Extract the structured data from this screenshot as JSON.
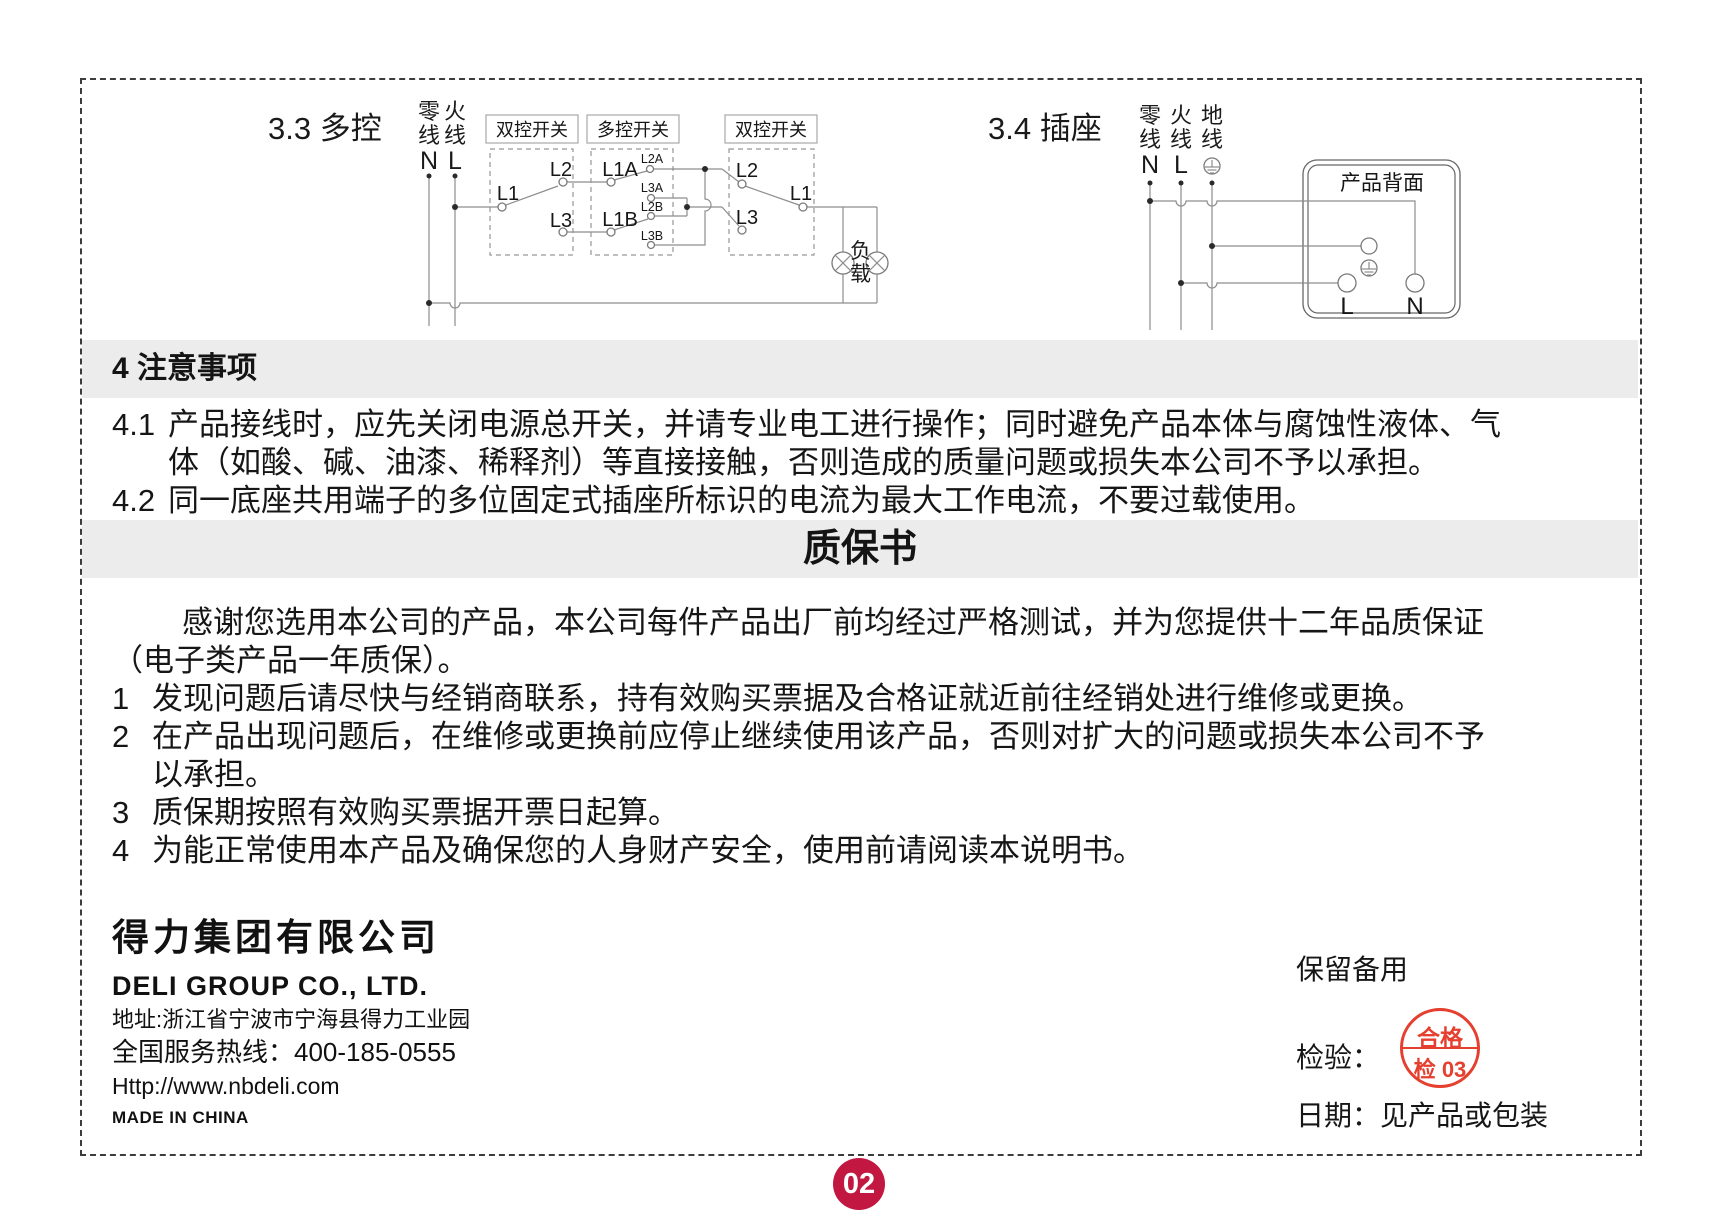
{
  "page": {
    "number": "02"
  },
  "diagram_multi": {
    "title": "3.3 多控",
    "neutral_label": "零线",
    "neutral_letter": "N",
    "live_label": "火线",
    "live_letter": "L",
    "switch1_title": "双控开关",
    "switch2_title": "多控开关",
    "switch3_title": "双控开关",
    "sw1_l1": "L1",
    "sw1_l2": "L2",
    "sw1_l3": "L3",
    "sw2_l1a": "L1A",
    "sw2_l1b": "L1B",
    "sw2_l2a": "L2A",
    "sw2_l3a": "L3A",
    "sw2_l2b": "L2B",
    "sw2_l3b": "L3B",
    "sw3_l1": "L1",
    "sw3_l2": "L2",
    "sw3_l3": "L3",
    "load_label": "负载"
  },
  "diagram_socket": {
    "title": "3.4 插座",
    "neutral_label": "零线",
    "neutral_letter": "N",
    "live_label": "火线",
    "live_letter": "L",
    "earth_label": "地线",
    "panel_title": "产品背面",
    "terminal_l": "L",
    "terminal_n": "N"
  },
  "precautions": {
    "heading": "4 注意事项",
    "items": [
      {
        "num": "4.1",
        "lines": [
          "产品接线时，应先关闭电源总开关，并请专业电工进行操作；同时避免产品本体与腐蚀性液体、气",
          "体（如酸、碱、油漆、稀释剂）等直接接触，否则造成的质量问题或损失本公司不予以承担。"
        ]
      },
      {
        "num": "4.2",
        "lines": [
          "同一底座共用端子的多位固定式插座所标识的电流为最大工作电流，不要过载使用。"
        ]
      }
    ]
  },
  "warranty": {
    "heading": "质保书",
    "intro_lines": [
      "感谢您选用本公司的产品，本公司每件产品出厂前均经过严格测试，并为您提供十二年品质保证",
      "（电子类产品一年质保）。"
    ],
    "items": [
      {
        "num": "1",
        "lines": [
          "发现问题后请尽快与经销商联系，持有效购买票据及合格证就近前往经销处进行维修或更换。"
        ]
      },
      {
        "num": "2",
        "lines": [
          "在产品出现问题后，在维修或更换前应停止继续使用该产品，否则对扩大的问题或损失本公司不予",
          "以承担。"
        ]
      },
      {
        "num": "3",
        "lines": [
          "质保期按照有效购买票据开票日起算。"
        ]
      },
      {
        "num": "4",
        "lines": [
          "为能正常使用本产品及确保您的人身财产安全，使用前请阅读本说明书。"
        ]
      }
    ]
  },
  "footer": {
    "company_cn": "得力集团有限公司",
    "company_en": "DELI GROUP CO., LTD.",
    "address": "地址:浙江省宁波市宁海县得力工业园",
    "hotline_label": "全国服务热线：",
    "hotline_number": "400-185-0555",
    "website": "Http://www.nbdeli.com",
    "made_in": "MADE IN CHINA",
    "reserve_note": "保留备用",
    "inspection_label": "检验：",
    "stamp_top": "合格",
    "stamp_bottom": "检 03",
    "date_label": "日期：",
    "date_value": "见产品或包装"
  }
}
